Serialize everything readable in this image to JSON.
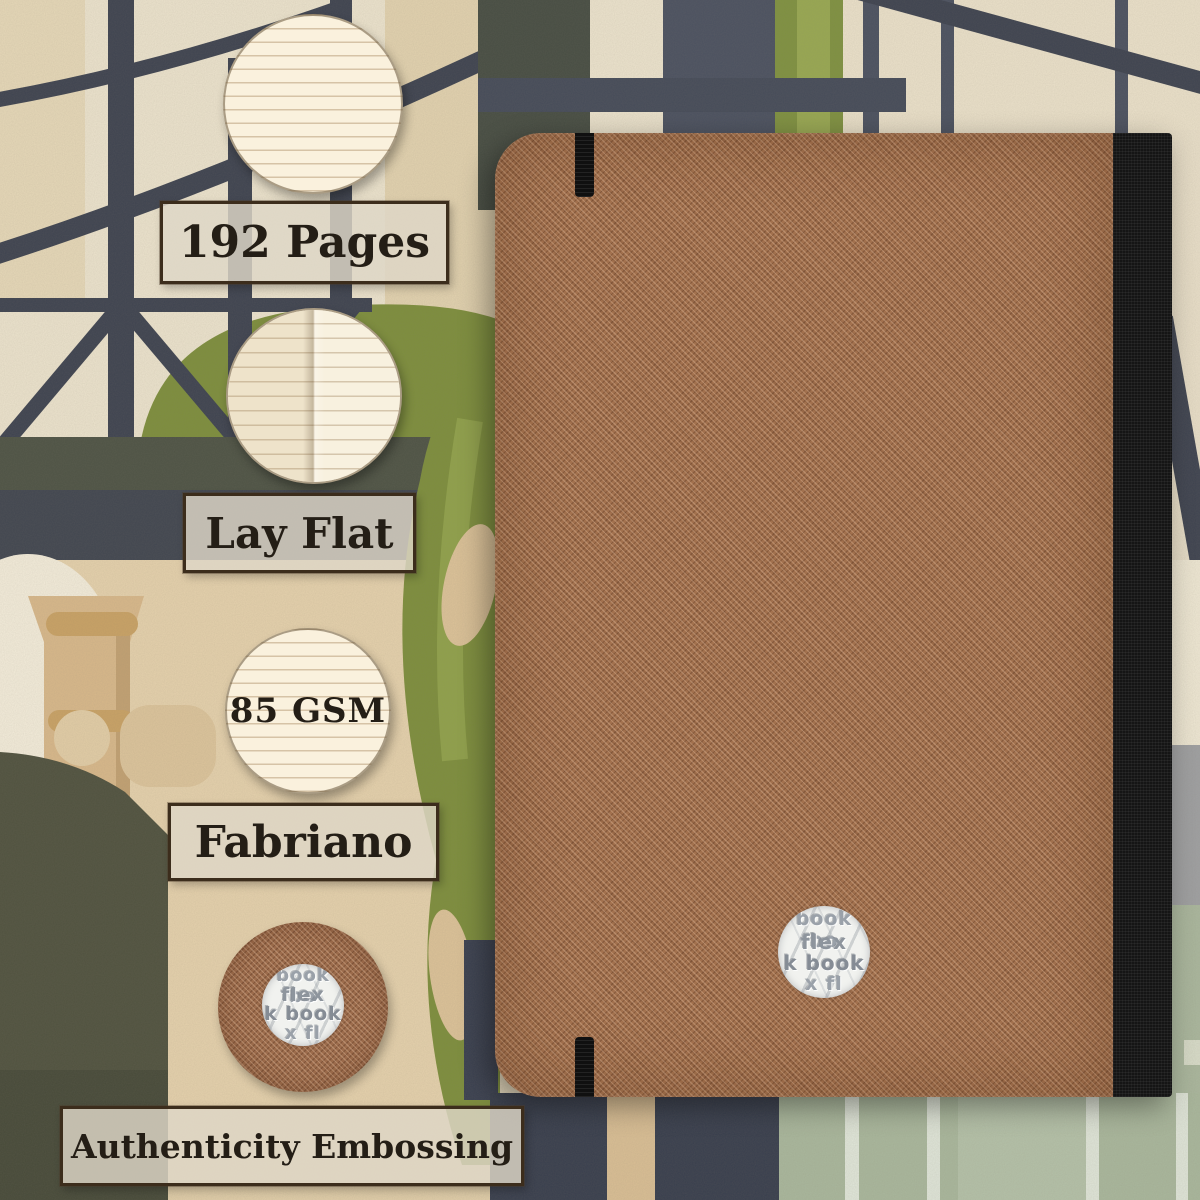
{
  "labels": {
    "pages": "192 Pages",
    "lay_flat": "Lay Flat",
    "gsm": "85 GSM",
    "paper_brand": "Fabriano",
    "embossing": "Authenticity Embossing"
  },
  "emboss_logo": {
    "line1": "book bo",
    "line2": "flex",
    "line3": "k book",
    "line4": "x fl"
  },
  "colors": {
    "cover_brown": "#a2714e",
    "spine_black": "#151515",
    "elastic_black": "#101010",
    "label_fill": "#ded7c7",
    "label_border": "#3c2d1c",
    "label_text": "#241e16",
    "paper_cream": "#faf1dd",
    "foliage_green": "#7d8e3c",
    "beam_slate": "#3e4350",
    "wall_cream": "#ece3cd",
    "beige": "#e5d1ac",
    "column_tan": "#d8b88a",
    "pot_sage": "#a9b79c",
    "dark_olive": "#50523f",
    "navy_blue": "#383e4d",
    "emboss_gray": "#8e959d"
  }
}
